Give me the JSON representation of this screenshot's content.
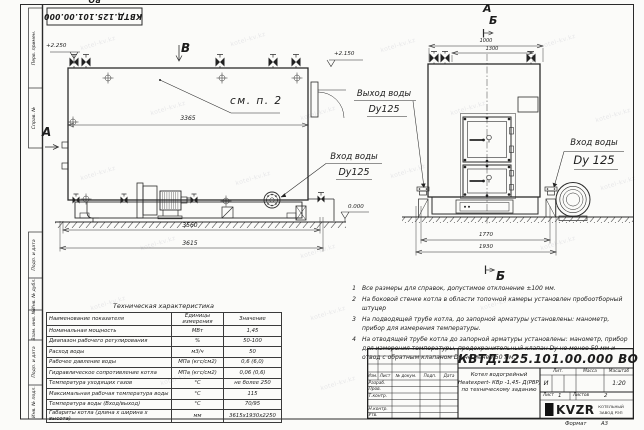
{
  "sheet": {
    "watermark": "kotel-kv.kz",
    "format_label": "Формат",
    "format_value": "А3"
  },
  "frame": {
    "top_stamp": "КВТД.125.101.00.000 ВО",
    "col_perv_primen": "Перв. примен.",
    "col_sprav_no": "Справ. №",
    "col_podp_data1": "Подп. и дата",
    "col_inv_dubl": "Инв. № дубл.",
    "col_vzam_inv": "Взам. инв. №",
    "col_podp_data2": "Подп. и дата",
    "col_inv_podl": "Инв. № подл."
  },
  "drawing": {
    "side_view": {
      "view_letter": "В",
      "section_letter": "А",
      "elev_top": "+2.250",
      "see_note": "см. п. 2",
      "dim_inner": "3365",
      "dim_base": "3560",
      "dim_total": "3615"
    },
    "front_view": {
      "letter_a": "А",
      "letter_b": "Б",
      "letter_b_bottom": "Б",
      "dim_top_outer": "1000",
      "dim_top_inner": "1300",
      "dim_base_inner": "1770",
      "dim_base_outer": "1930",
      "elev_outlet": "+2.150",
      "elev_ground": "0.000"
    },
    "callouts": {
      "outlet_line1": "Выход воды",
      "outlet_line2": "Dy125",
      "inlet_side_line1": "Вход воды",
      "inlet_side_line2": "Dy125",
      "inlet_front_line1": "Вход воды",
      "inlet_front_line2": "Dy 125"
    }
  },
  "notes": {
    "items": [
      {
        "num": "1",
        "text": "Все размеры для справок, допустимое отклонение ±100 мм."
      },
      {
        "num": "2",
        "text": "На боковой стенке котла в области топочной камеры установлен пробоотборный штуцер"
      },
      {
        "num": "3",
        "text": "На подводящей трубе котла, до запорной арматуры установлены: манометр, прибор для измерения температуры."
      },
      {
        "num": "4",
        "text": "На отводящей трубе котла до запорной арматуры установлены: манометр, прибор для измерения температуры, предохранительный клапан Dy не менее 50 мм и отвод с обратным клапаном Dy не менее 50 мм."
      }
    ]
  },
  "tech_table": {
    "title": "Техническая характеристика",
    "headers": [
      "Наименование показателя",
      "Единицы измерения",
      "Значение"
    ],
    "rows": [
      [
        "Номинальная мощность",
        "МВт",
        "1,45"
      ],
      [
        "Диапазон рабочего регулирования",
        "%",
        "50-100"
      ],
      [
        "Расход воды",
        "м3/ч",
        "50"
      ],
      [
        "Рабочее давление воды",
        "МПа (кгс/см2)",
        "0,6 (6,0)"
      ],
      [
        "Гидравлическое сопротивление котла",
        "МПа (кгс/см2)",
        "0,06 (0,6)"
      ],
      [
        "Температура уходящих газов",
        "°С",
        "не более 250"
      ],
      [
        "Максимальная рабочая температура воды",
        "°С",
        "115"
      ],
      [
        "Температура воды (Вход/выход)",
        "°С",
        "70/95"
      ],
      [
        "Габариты котла (длина х ширина х высота)",
        "мм",
        "3615х1930х2250"
      ]
    ]
  },
  "title_block": {
    "doc_number": "КВТД.125.101.00.000 ВО",
    "header_cols": [
      "Изм.",
      "Лист",
      "№ докум.",
      "Подп.",
      "Дата"
    ],
    "row_labels": [
      "Разраб.",
      "Пров.",
      "Т.контр.",
      "",
      "Н.контр.",
      "Утв."
    ],
    "product_line1": "Котел водогрейный",
    "product_line2": "Heatexpert- КВр -1,45- Д(РВР)",
    "product_line3": "по техническому заданию",
    "lit_label": "Лит.",
    "lit_value": "И",
    "mass_label": "Масса",
    "scale_label": "Масштаб",
    "scale_value": "1:20",
    "sheet_label": "Лист",
    "sheet_value": "1",
    "sheets_label": "Листов",
    "sheets_value": "2",
    "logo_text": "KVZR",
    "company_line1": "КОТЕЛЬНЫЙ",
    "company_line2": "ЗАВОД РЭП"
  }
}
